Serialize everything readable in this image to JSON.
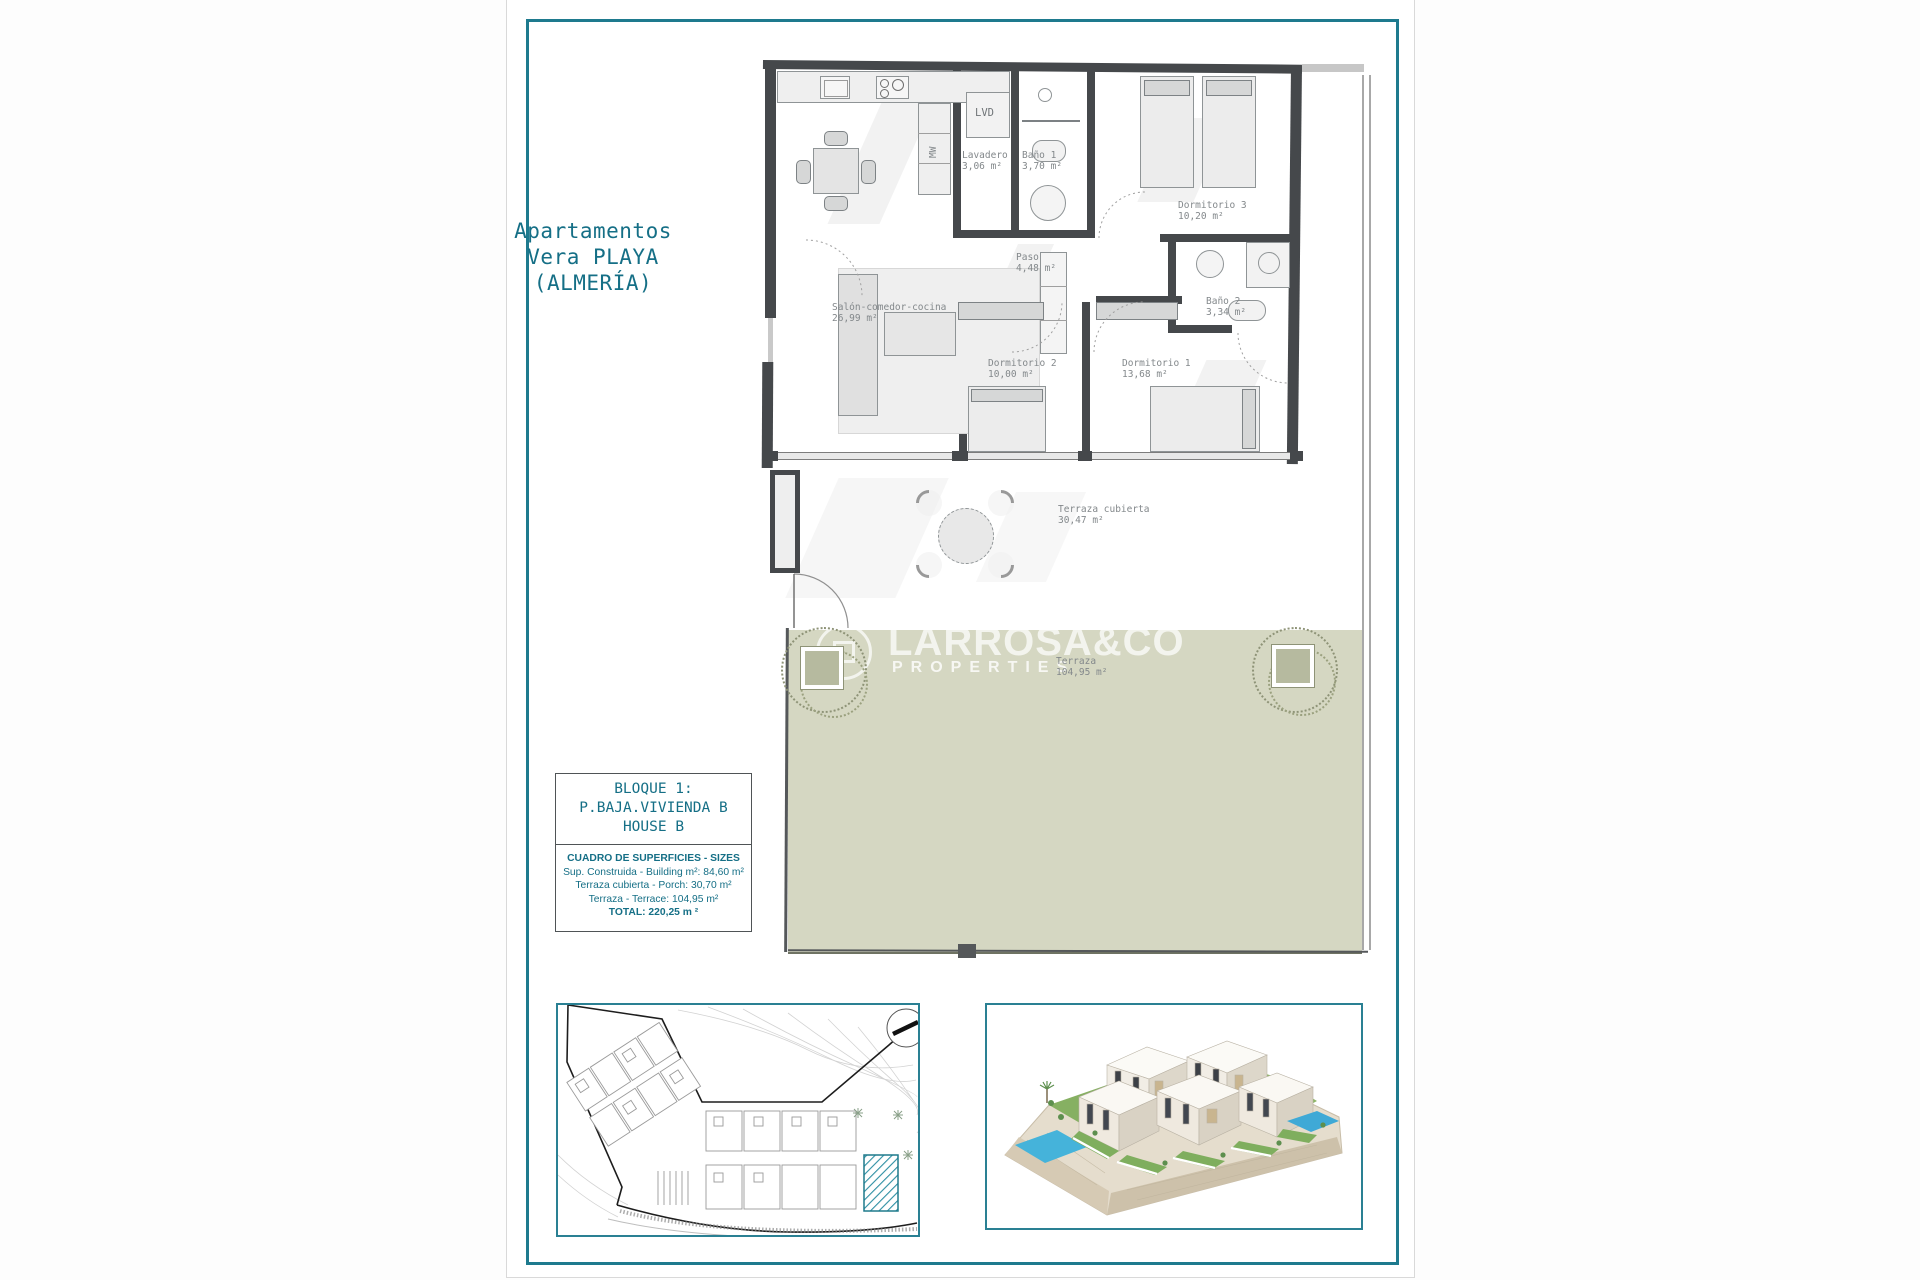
{
  "page": {
    "title_line1": "Apartamentos",
    "title_line2": "Vera PLAYA",
    "title_line3": "(ALMERÍA)"
  },
  "watermark": {
    "brand": "LARROSA&CO",
    "tagline": "PROPERTIES"
  },
  "plan": {
    "rooms": [
      {
        "name": "Salón-comedor-cocina",
        "area": "26,99 m²"
      },
      {
        "name": "Lavadero",
        "area": "3,06 m²"
      },
      {
        "name": "Baño 1",
        "area": "3,70 m²"
      },
      {
        "name": "Dormitorio 3",
        "area": "10,20 m²"
      },
      {
        "name": "Paso",
        "area": "4,48 m²"
      },
      {
        "name": "Baño 2",
        "area": "3,34 m²"
      },
      {
        "name": "Dormitorio 2",
        "area": "10,00 m²"
      },
      {
        "name": "Dormitorio 1",
        "area": "13,68 m²"
      },
      {
        "name": "Terraza cubierta",
        "area": "30,47 m²"
      },
      {
        "name": "Terraza",
        "area": "104,95 m²"
      }
    ],
    "labels": {
      "laundry_closet": "LVD",
      "microwave": "MW"
    }
  },
  "info_box": {
    "title_line1": "BLOQUE 1:",
    "title_line2": "P.BAJA.VIVIENDA B",
    "title_line3": "HOUSE B",
    "table_header": "CUADRO DE SUPERFICIES  - SIZES",
    "row_built": "Sup. Construida  - Building m²: 84,60 m²",
    "row_porch": "Terraza cubierta  - Porch: 30,70 m²",
    "row_terrace": "Terraza - Terrace: 104,95 m²",
    "row_total": "TOTAL:  220,25 m ²"
  },
  "colors": {
    "frame_teal": "#1e7a8e",
    "text_teal": "#156f86",
    "terrace_green": "#d5d7c2",
    "wall_grey": "#45484b",
    "pool_blue": "#45b3da"
  }
}
